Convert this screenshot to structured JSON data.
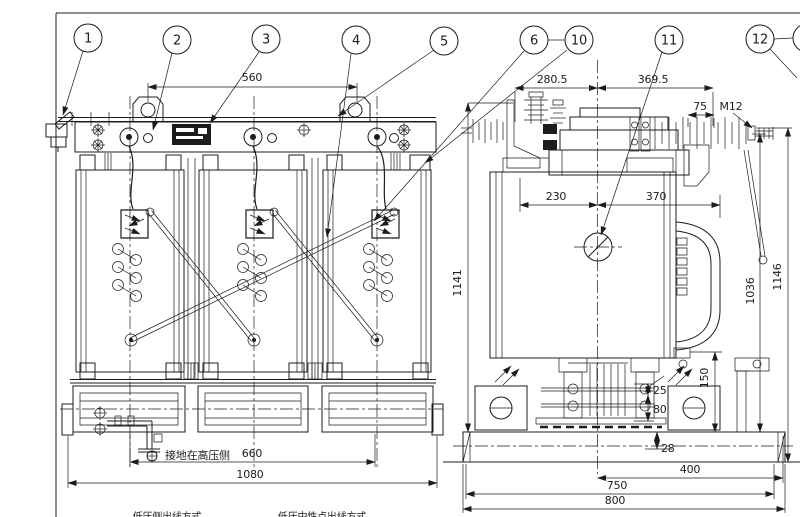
{
  "title": "transformer-outline-drawing",
  "colors": {
    "ink": "#1c1c1c",
    "paper": "#ffffff"
  },
  "balloons": {
    "n1": "1",
    "n2": "2",
    "n3": "3",
    "n4": "4",
    "n5": "5",
    "n6": "6",
    "n10": "10",
    "n11": "11",
    "n12": "12"
  },
  "front_view": {
    "dims": {
      "lug_spacing": "560",
      "wheel_spacing": "660",
      "base_width": "1080"
    },
    "notes": {
      "grounding": "接地在高压侧",
      "caption_left": "低压侧出线方式",
      "caption_right": "低压中性点出线方式"
    }
  },
  "side_view": {
    "dims": {
      "top_left": "280.5",
      "top_right": "369.5",
      "stud_length": "75",
      "thread": "M12",
      "mid_left": "230",
      "mid_right": "370",
      "height_frame": "1141",
      "height_hv": "1036",
      "height_overall": "1146",
      "handle_to_base": "150",
      "gap_a": "25",
      "gap_b": "80",
      "gap_c": "28",
      "base_half": "400",
      "base_inner": "750",
      "base_full": "800"
    }
  }
}
